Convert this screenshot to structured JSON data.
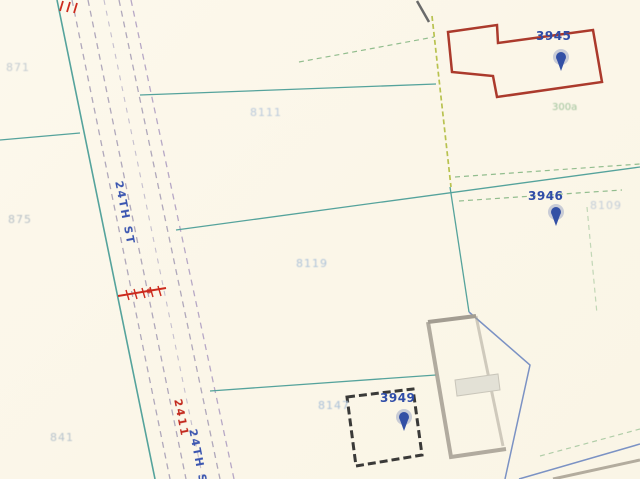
{
  "map": {
    "description_labels": {
      "parcels": [
        {
          "text": "8111"
        },
        {
          "text": "8119"
        },
        {
          "text": "875"
        },
        {
          "text": "871"
        },
        {
          "text": "841"
        },
        {
          "text": "8147"
        },
        {
          "text": "8109"
        }
      ],
      "points": [
        {
          "text": "3945"
        },
        {
          "text": "3946"
        },
        {
          "text": "3949"
        }
      ],
      "zoning": [
        {
          "text": "300a"
        }
      ],
      "streets": [
        {
          "text": "24TH ST"
        },
        {
          "text": "2411"
        },
        {
          "text": "24TH ST"
        }
      ]
    },
    "colors": {
      "background": "#fcf8ec",
      "road_edge_teal": "#55a39c",
      "road_dash_gray": "#b0a8bb",
      "road_dash_purple": "#b7a8c6",
      "parcel_boundary_teal": "#55a39c",
      "parcel_boundary_blue": "#7b92c4",
      "dashed_green": "#92bd8e",
      "dashed_yellow_green": "#b8c24f",
      "building_red": "#ab3a2c",
      "building_black": "#3a3a38",
      "building_gray": "#a39d92",
      "marker_blue": "#3350a5",
      "label_light_blue": "#aec3d9",
      "label_green": "#9fc39b",
      "hatch_red": "#cc2b1e"
    }
  }
}
